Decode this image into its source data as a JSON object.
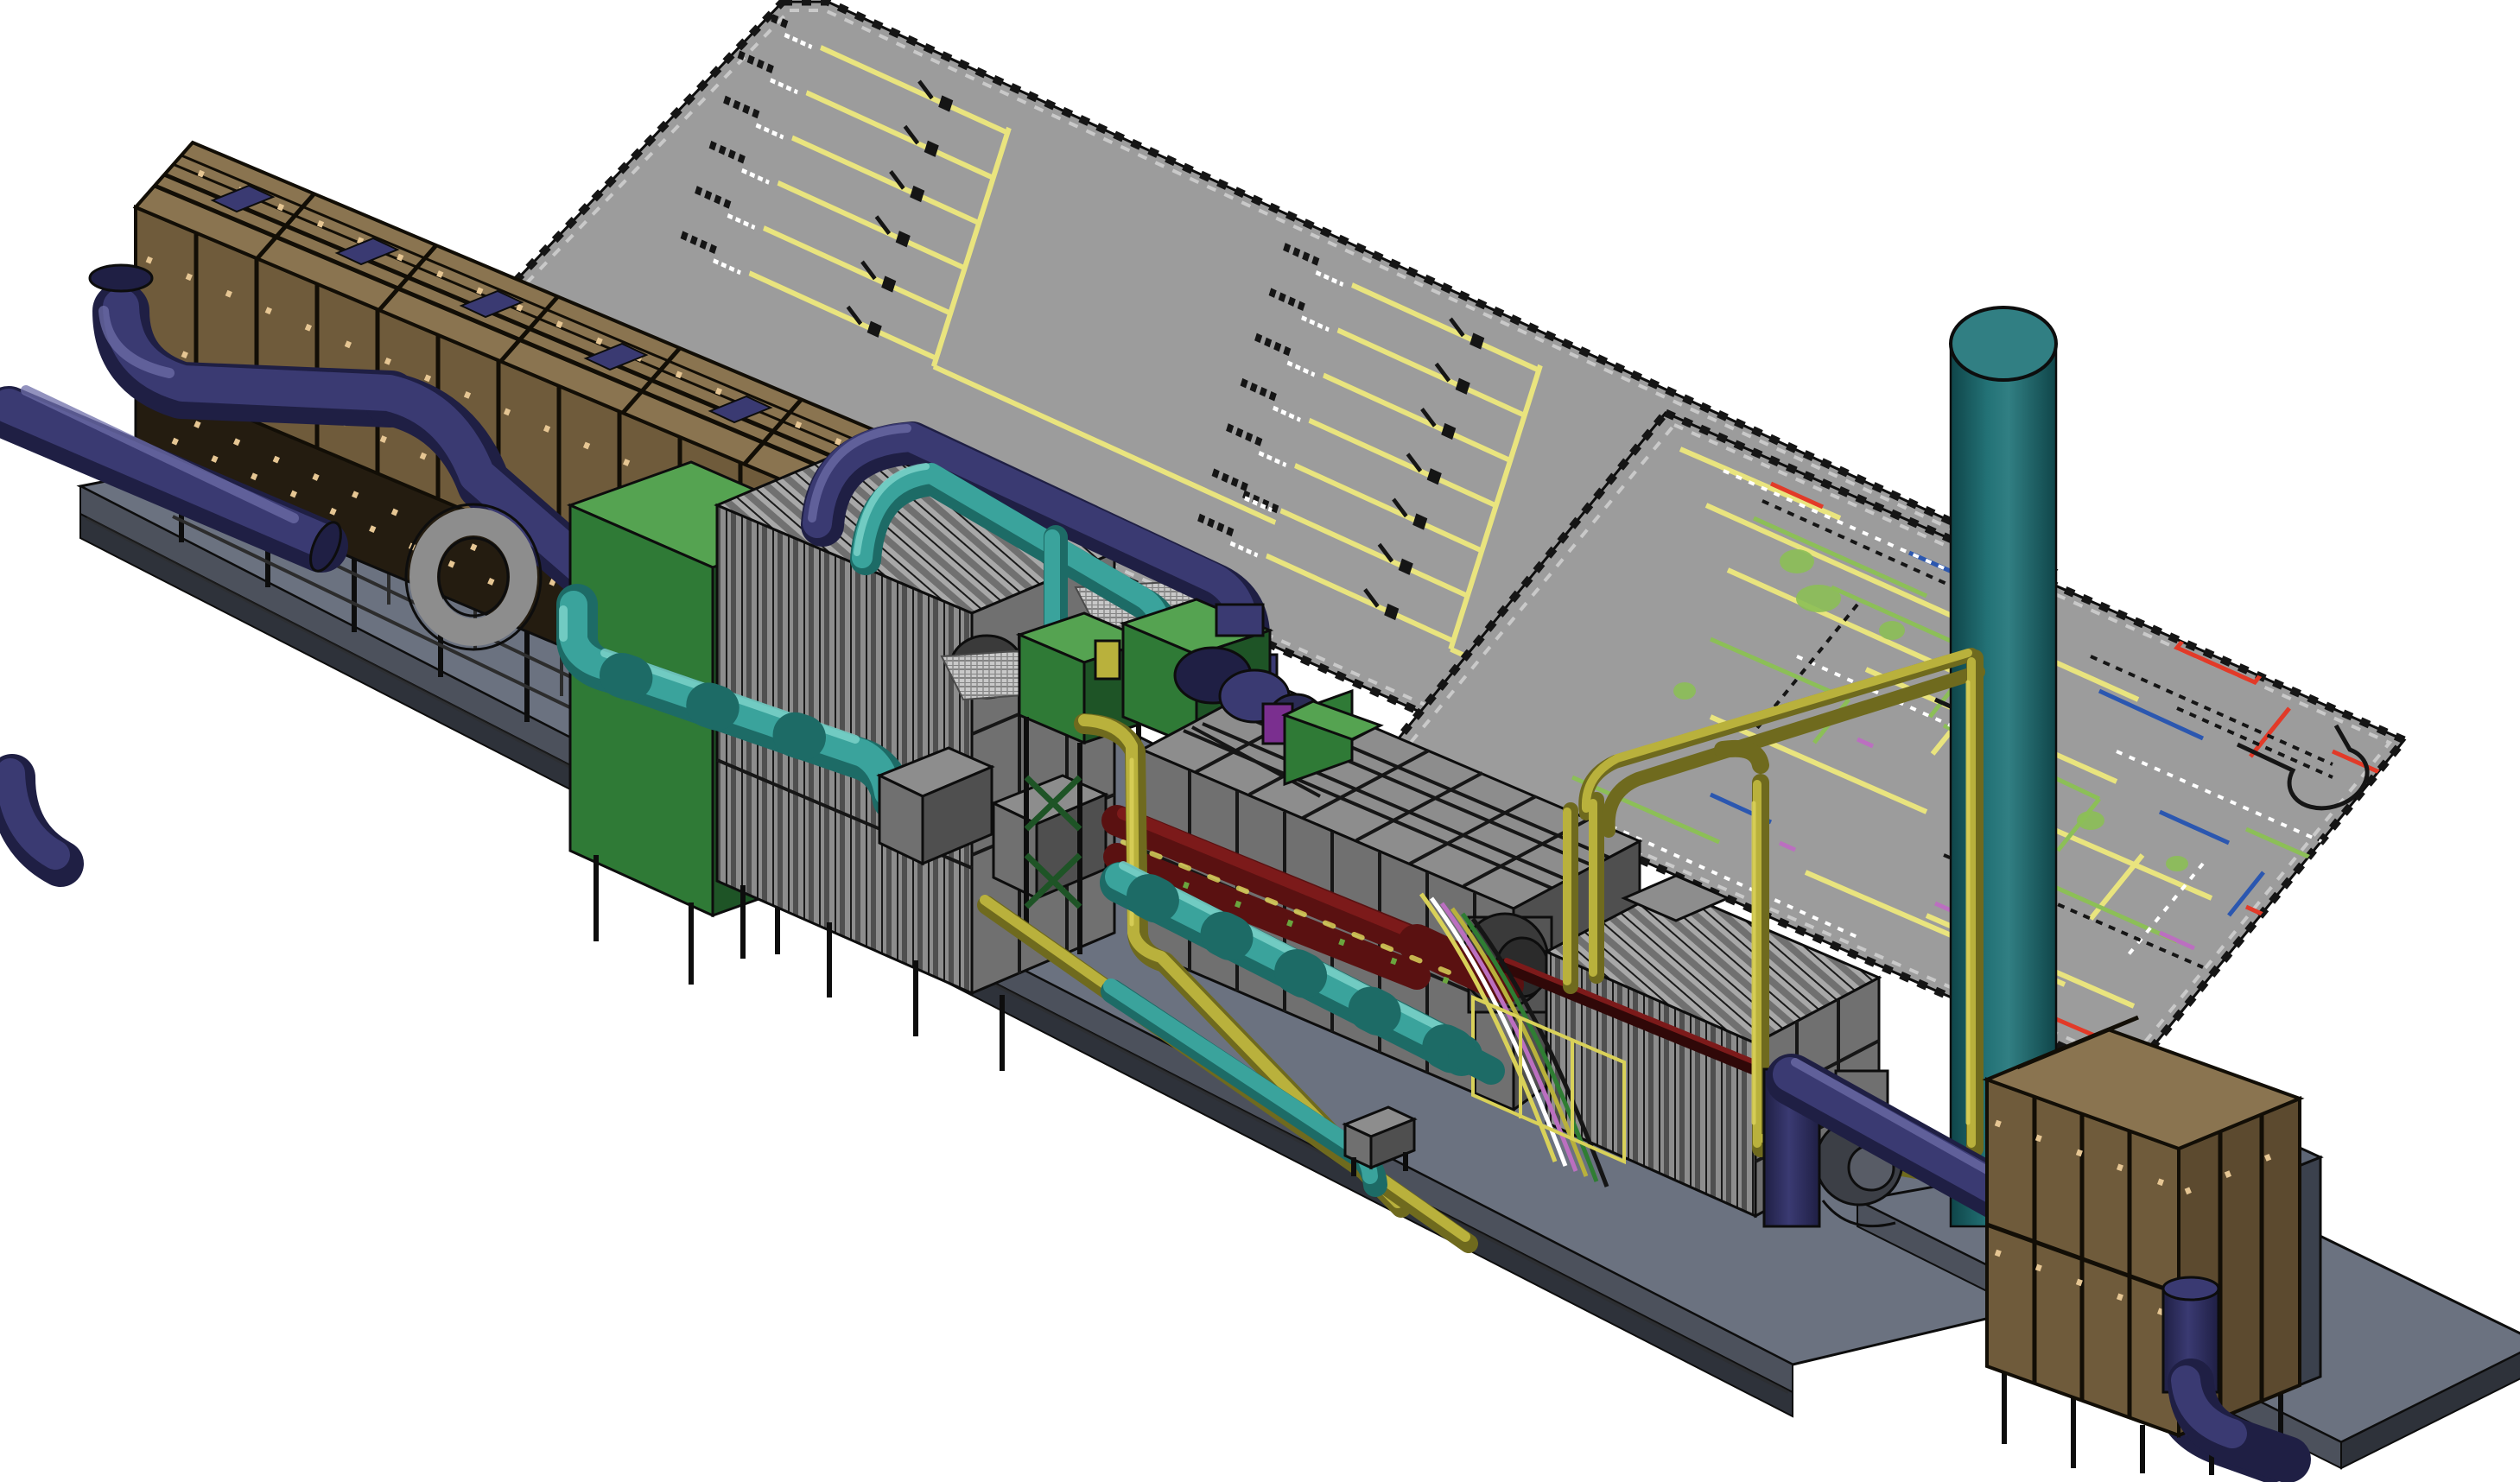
{
  "meta": {
    "render_type": "3d-cad-isometric-plant-model",
    "background": "#ffffff",
    "visible_text": "none (diagram annotations are below legibility scale)"
  },
  "palette": {
    "bg": "#ffffff",
    "panel_gray": "#9c9c9c",
    "panel_edge": "#6e6e6e",
    "diagram_yellow": "#e9e47e",
    "diagram_green": "#8cbf57",
    "diagram_dkgreen": "#2f7d33",
    "diagram_blue": "#2b57b0",
    "diagram_red": "#e23a28",
    "diagram_white": "#ffffff",
    "diagram_black": "#151515",
    "diagram_magenta": "#bb6fc0",
    "base_top": "#6b7280",
    "base_side": "#4c515c",
    "base_dark": "#2e323a",
    "outline": "#0d0d0d",
    "tan_top": "#8a7450",
    "tan_front": "#6f5b3b",
    "tan_side": "#5c4a2f",
    "tan_frame": "#120e06",
    "tan_speckle": "#e6c693",
    "navy_light": "#6e6ea8",
    "navy_mid": "#3a3a72",
    "navy_dark": "#1f1f44",
    "cyan_light": "#7fd4cc",
    "cyan_mid": "#3aa39c",
    "cyan_dark": "#1d6b66",
    "stack_light": "#317f83",
    "stack_mid": "#237276",
    "stack_dark": "#0f4549",
    "green_top": "#55a351",
    "green_front": "#2f7a36",
    "green_dark": "#1e5426",
    "eq_light": "#a8a8a8",
    "eq_mid": "#8d8d8d",
    "eq_shadow": "#707070",
    "eq_dark": "#4f4f4f",
    "eq_darker": "#3a3a3a",
    "maroon": "#5a1111",
    "maroon_light": "#7c1a1a",
    "pipe_yellow": "#b9b13c",
    "pipe_yellow_light": "#d9d159",
    "pipe_yellow_dark": "#6f6a1e",
    "slate_box": "#4e5563",
    "slate_box_top": "#5e6675",
    "grating": "#c9c9c9"
  },
  "components": [
    {
      "name": "single-line-diagram-board",
      "color_key": "panel_gray",
      "line_color_key": "diagram_yellow"
    },
    {
      "name": "pid-layout-board",
      "color_key": "panel_gray",
      "line_color_keys": [
        "diagram_yellow",
        "diagram_green",
        "diagram_blue",
        "diagram_red",
        "diagram_white",
        "diagram_black",
        "diagram_magenta"
      ]
    },
    {
      "name": "air-intake-filter-house-left",
      "color_key": "tan_front"
    },
    {
      "name": "air-intake-filter-house-right",
      "color_key": "tan_front"
    },
    {
      "name": "intake-ducting",
      "color_key": "navy_mid"
    },
    {
      "name": "inlet-plenum-boxes",
      "color_key": "green_front"
    },
    {
      "name": "charge-air-cooler-bank-left",
      "color_key": "eq_mid"
    },
    {
      "name": "cooling-water-piping",
      "color_key": "cyan_mid"
    },
    {
      "name": "engine-generator-block",
      "color_key": "eq_mid"
    },
    {
      "name": "exhaust-manifold-piping",
      "color_key": "maroon"
    },
    {
      "name": "fuel-gas-piping",
      "color_key": "pipe_yellow"
    },
    {
      "name": "radiator-generator-bank-right",
      "color_key": "eq_mid"
    },
    {
      "name": "exhaust-stack",
      "color_key": "stack_mid"
    },
    {
      "name": "auxiliary-slate-cabinet",
      "color_key": "slate_box"
    },
    {
      "name": "base-skid",
      "color_key": "base_top"
    }
  ],
  "boards": {
    "left": {
      "style": "one-line electrical diagram",
      "feeder_groups": [
        {
          "feeders": 6
        },
        {
          "feeders": 7
        },
        {
          "feeders": 3
        }
      ]
    },
    "right": {
      "style": "piping and instrumentation layout",
      "dominant_colors": [
        "diagram_yellow",
        "diagram_green"
      ]
    }
  }
}
